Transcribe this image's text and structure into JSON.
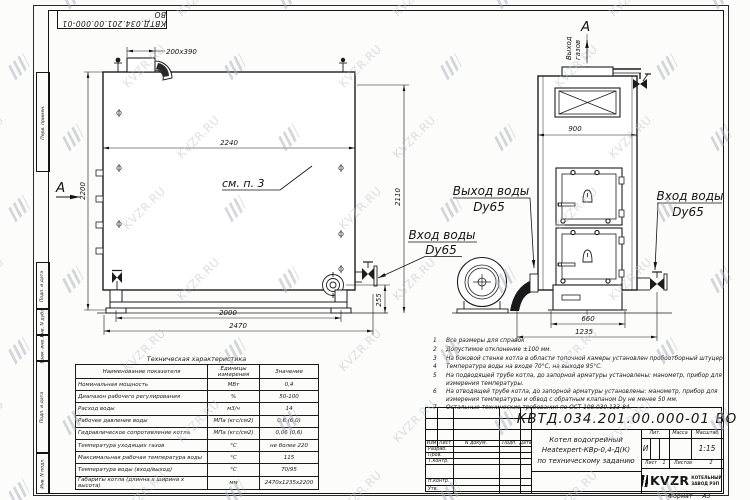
{
  "watermark": {
    "text": "KVZR.RU"
  },
  "corner_stamp": "КВТД.034.201.00.000-01 ВО",
  "frame_labels": {
    "perv": "Перв. примен.",
    "podp1": "Подп. и дата",
    "inv_dubl": "Инв. N дубл.",
    "vzam": "Взам. инв. N",
    "podp2": "Подп. и дата",
    "inv_podl": "Инв. N подл."
  },
  "side_view": {
    "section_label": "А",
    "see_note": "см. п. 3",
    "dims": {
      "duct": "200x390",
      "top": "2240",
      "height_left": "2200",
      "height_right": "2110",
      "valve_height": "255",
      "feet": "2000",
      "total": "2470"
    }
  },
  "front_view": {
    "view_label": "А",
    "gas_out_line1": "Выход",
    "gas_out_line2": "газов",
    "dims": {
      "width": "900",
      "base": "660",
      "total": "1235"
    },
    "labels": {
      "water_out": "Выход воды",
      "water_out_dn": "Dy65",
      "water_in_right": "Вход воды",
      "water_in_right_dn": "Dy65",
      "water_in_left": "Вход воды",
      "water_in_left_dn": "Dy65"
    }
  },
  "notes": [
    {
      "n": "1",
      "text": "Все размеры для справок"
    },
    {
      "n": "2",
      "text": "Допустимое отклонение ±100 мм."
    },
    {
      "n": "3",
      "text": "На боковой стенке котла в области топочной камеры установлен пробоотборный штуцер"
    },
    {
      "n": "4",
      "text": "Температура воды на входе 70°С, на выходе 95°С."
    },
    {
      "n": "5",
      "text": "На подводящей трубе котла, до запорной арматуры установлены: манометр, прибор для измерения температуры."
    },
    {
      "n": "6",
      "text": "На отводящей трубе котла, до запорной арматуры установлены: манометр, прибор для измерения температуры и обвод с обратным клапаном Dу не менее 50 мм."
    },
    {
      "n": "7",
      "text": "Остальные технические требования по ОСТ 108.030.133-84."
    }
  ],
  "tech": {
    "title": "Техническая характеристика",
    "headers": [
      "Наименование показателя",
      "Единицы измерения",
      "Значение"
    ],
    "rows": [
      [
        "Номинальная мощность",
        "МВт",
        "0,4"
      ],
      [
        "Диапазон рабочего регулирования",
        "%",
        "50-100"
      ],
      [
        "Расход воды",
        "м3/ч",
        "14"
      ],
      [
        "Рабочее давление воды",
        "МПа (кгс/см2)",
        "0,6 (6,0)"
      ],
      [
        "Гидравлическое сопротивление котла",
        "МПа (кгс/см2)",
        "0,06 (0,6)"
      ],
      [
        "Температура уходящих газов",
        "°С",
        "не более 220"
      ],
      [
        "Максимальная рабочая температура воды",
        "°С",
        "115"
      ],
      [
        "Температура воды (вход/выход)",
        "°С",
        "70/95"
      ],
      [
        "Габариты котла (длинна х ширина х высота)",
        "мм",
        "2470х1235х2200"
      ]
    ]
  },
  "title_block": {
    "doc_number": "КВТД.034.201.00.000-01 ВО",
    "name_line1": "Котел водогрейный",
    "name_line2": "Heatexpert-КВр-0,4-Д(К)",
    "name_line3": "по техническому заданию",
    "col_izm": "Изм",
    "col_list": "Лист",
    "col_doc": "N докум.",
    "col_podp": "Подп.",
    "col_data": "Дата",
    "row_razrab": "Разраб.",
    "row_prov": "Пров.",
    "row_tkontr": "Т.контр.",
    "row_nkontr": "Н.контр.",
    "row_utv": "Утв.",
    "lit_header": "Лит.",
    "lit_value": "И",
    "mass_header": "Масса",
    "scale_header": "Масштаб",
    "scale_value": "1:15",
    "sheet_label": "Лист",
    "sheet_value": "1",
    "sheets_label": "Листов",
    "sheets_value": "2",
    "company": "KVZR",
    "company_sub1": "КОТЕЛЬНЫЙ",
    "company_sub2": "ЗАВОД РЭП",
    "format_label": "Формат",
    "format_value": "А3"
  }
}
